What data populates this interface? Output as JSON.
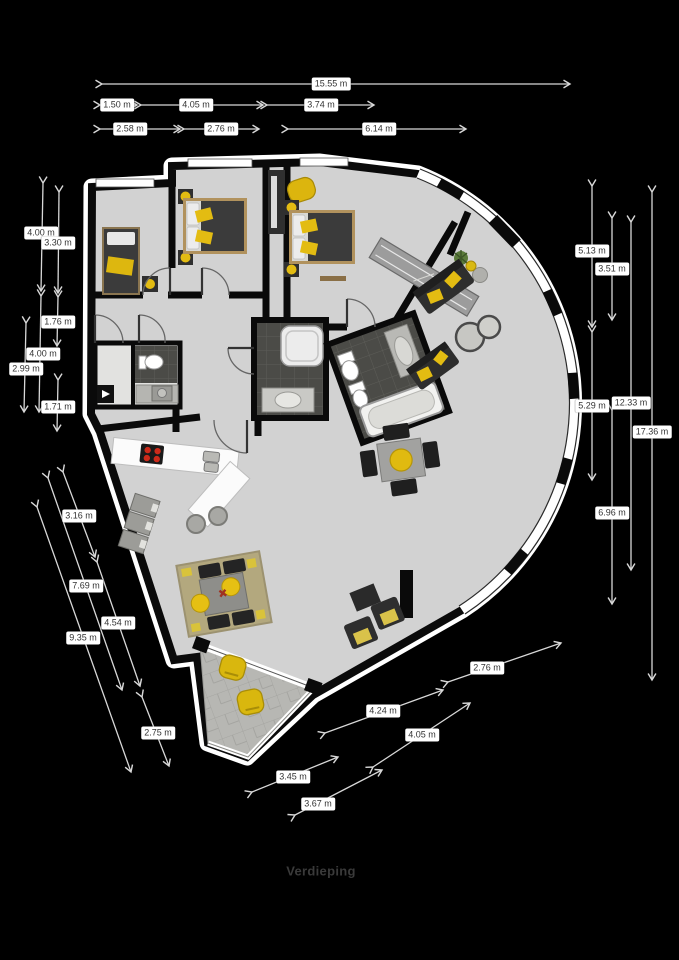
{
  "title": "Verdieping",
  "dims": {
    "top": [
      "15.55 m",
      "1.50 m",
      "4.05 m",
      "3.74 m",
      "2.58 m",
      "2.76 m",
      "6.14 m"
    ],
    "left": [
      "4.00 m",
      "3.30 m",
      "1.76 m",
      "4.00 m",
      "2.99 m",
      "1.71 m"
    ],
    "right": [
      "5.13 m",
      "3.51 m",
      "5.29 m",
      "12.33 m",
      "17.36 m",
      "6.96 m"
    ],
    "bottom_left": [
      "3.16 m",
      "7.69 m",
      "4.54 m",
      "9.35 m",
      "2.75 m"
    ],
    "bottom_right": [
      "2.76 m",
      "4.24 m",
      "4.05 m",
      "3.45 m",
      "3.67 m"
    ]
  },
  "colors": {
    "background": "#000000",
    "floor": "#d2d2d2",
    "wall": "#0a0a0a",
    "accent_yellow": "#ddb70f",
    "bathroom_tile": "#4b4b47",
    "terrace_tile": "#b7b7b3",
    "dimension_label_bg": "#ffffff",
    "dimension_text": "#333333"
  }
}
